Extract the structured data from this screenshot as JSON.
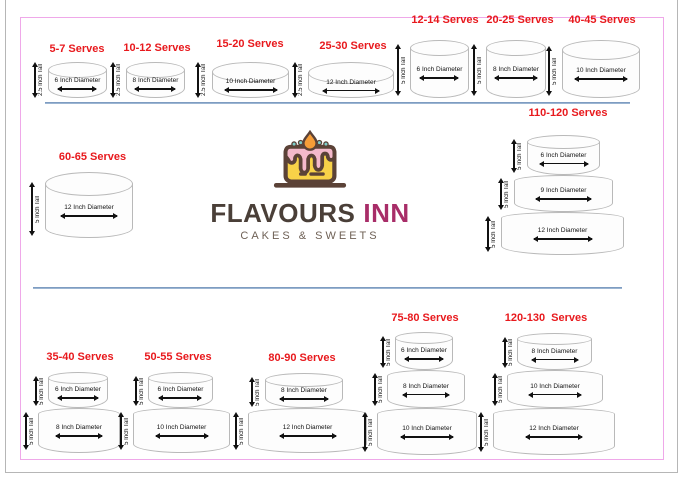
{
  "brand": {
    "name_primary": "FLAVOURS",
    "name_secondary": "INN",
    "tagline": "CAKES & SWEETS",
    "logo_icon": "cake-with-pink-frosting-and-candle-flame"
  },
  "colors": {
    "serves_red": "#e8191d",
    "brand_brown": "#4a3f38",
    "brand_magenta": "#a82d68",
    "tagline_brown": "#6f6156",
    "divider_blue": "#7e9bc2",
    "page_border_pink": "#efa8e9"
  },
  "cakes": [
    {
      "title": "5-7 Serves",
      "tiers": [
        {
          "height": "2.5 Inch Tall",
          "diameter": "6 Inch Diameter"
        }
      ]
    },
    {
      "title": "10-12 Serves",
      "tiers": [
        {
          "height": "2.5 Inch Tall",
          "diameter": "8 Inch Diameter"
        }
      ]
    },
    {
      "title": "15-20 Serves",
      "tiers": [
        {
          "height": "2.5 Inch Tall",
          "diameter": "10 Inch Diameter"
        }
      ]
    },
    {
      "title": "25-30 Serves",
      "tiers": [
        {
          "height": "2.5 Inch Tall",
          "diameter": "12 Inch Diameter"
        }
      ]
    },
    {
      "title": "12-14 Serves",
      "tiers": [
        {
          "height": "5 Inch Tall",
          "diameter": "6 Inch Diameter"
        }
      ]
    },
    {
      "title": "20-25 Serves",
      "tiers": [
        {
          "height": "5 Inch Tall",
          "diameter": "8 Inch Diameter"
        }
      ]
    },
    {
      "title": "40-45 Serves",
      "tiers": [
        {
          "height": "5 Inch Tall",
          "diameter": "10 Inch Diameter"
        }
      ]
    },
    {
      "title": "60-65 Serves",
      "tiers": [
        {
          "height": "5 Inch Tall",
          "diameter": "12 Inch Diameter"
        }
      ]
    },
    {
      "title": "110-120 Serves",
      "tiers": [
        {
          "height": "5 Inch Tall",
          "diameter": "6 Inch Diameter"
        },
        {
          "height": "5 Inch Tall",
          "diameter": "9 Inch Diameter"
        },
        {
          "height": "5 Inch Tall",
          "diameter": "12 Inch Diameter"
        }
      ]
    },
    {
      "title": "35-40 Serves",
      "tiers": [
        {
          "height": "5 Inch Tall",
          "diameter": "6 Inch Diameter"
        },
        {
          "height": "5 Inch Tall",
          "diameter": "8 Inch Diameter"
        }
      ]
    },
    {
      "title": "50-55 Serves",
      "tiers": [
        {
          "height": "5 Inch Tall",
          "diameter": "6 Inch Diameter"
        },
        {
          "height": "5 Inch Tall",
          "diameter": "10 Inch Diameter"
        }
      ]
    },
    {
      "title": "80-90 Serves",
      "tiers": [
        {
          "height": "5 Inch Tall",
          "diameter": "8 Inch Diameter"
        },
        {
          "height": "5 Inch Tall",
          "diameter": "12 Inch Diameter"
        }
      ]
    },
    {
      "title": "75-80 Serves",
      "tiers": [
        {
          "height": "5 Inch Tall",
          "diameter": "6 Inch Diameter"
        },
        {
          "height": "5 Inch Tall",
          "diameter": "8 Inch Diameter"
        },
        {
          "height": "5 Inch Tall",
          "diameter": "10 Inch Diameter"
        }
      ]
    },
    {
      "title": "120-130  Serves",
      "tiers": [
        {
          "height": "5 Inch Tall",
          "diameter": "8 Inch Diameter"
        },
        {
          "height": "5 Inch Tall",
          "diameter": "10 Inch Diameter"
        },
        {
          "height": "5 Inch Tall",
          "diameter": "12 Inch Diameter"
        }
      ]
    }
  ]
}
